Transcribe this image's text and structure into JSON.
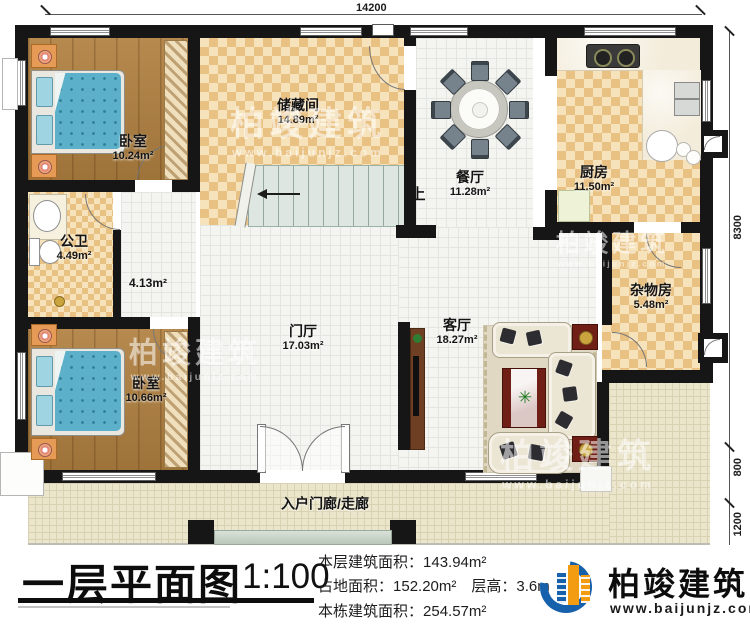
{
  "plan": {
    "dimensions": {
      "top": "14200",
      "right_top": "8300",
      "right_mid": "800",
      "right_bottom": "1200"
    },
    "rooms": {
      "bedroom1": {
        "name": "卧室",
        "area": "10.24m²"
      },
      "storage": {
        "name": "储藏间",
        "area": "14.89m²"
      },
      "dining": {
        "name": "餐厅",
        "area": "11.28m²"
      },
      "kitchen": {
        "name": "厨房",
        "area": "11.50m²"
      },
      "bathroom": {
        "name": "公卫",
        "area": "4.49m²"
      },
      "corridor": {
        "area": "4.13m²"
      },
      "utility": {
        "name": "杂物房",
        "area": "5.48m²"
      },
      "foyer": {
        "name": "门厅",
        "area": "17.03m²"
      },
      "living": {
        "name": "客厅",
        "area": "18.27m²"
      },
      "bedroom2": {
        "name": "卧室",
        "area": "10.66m²"
      },
      "porch": {
        "name": "入户门廊/走廊"
      }
    },
    "stairs": {
      "direction": "上"
    }
  },
  "title_block": {
    "title": "一层平面图",
    "scale": "1:100",
    "stat1_label": "本层建筑面积：",
    "stat1_value": "143.94m²",
    "stat2_label": "占地面积：",
    "stat2_value": "152.20m²",
    "stat3_label": "层高：",
    "stat3_value": "3.6m",
    "stat4_label": "本栋建筑面积：",
    "stat4_value": "254.57m²"
  },
  "brand": {
    "name": "柏竣建筑",
    "website": "www.baijunjz.com",
    "blue": "#1761ac",
    "orange": "#f39c12"
  },
  "watermark": {
    "name": "柏竣建筑",
    "website": "www.baijunjz.com"
  }
}
